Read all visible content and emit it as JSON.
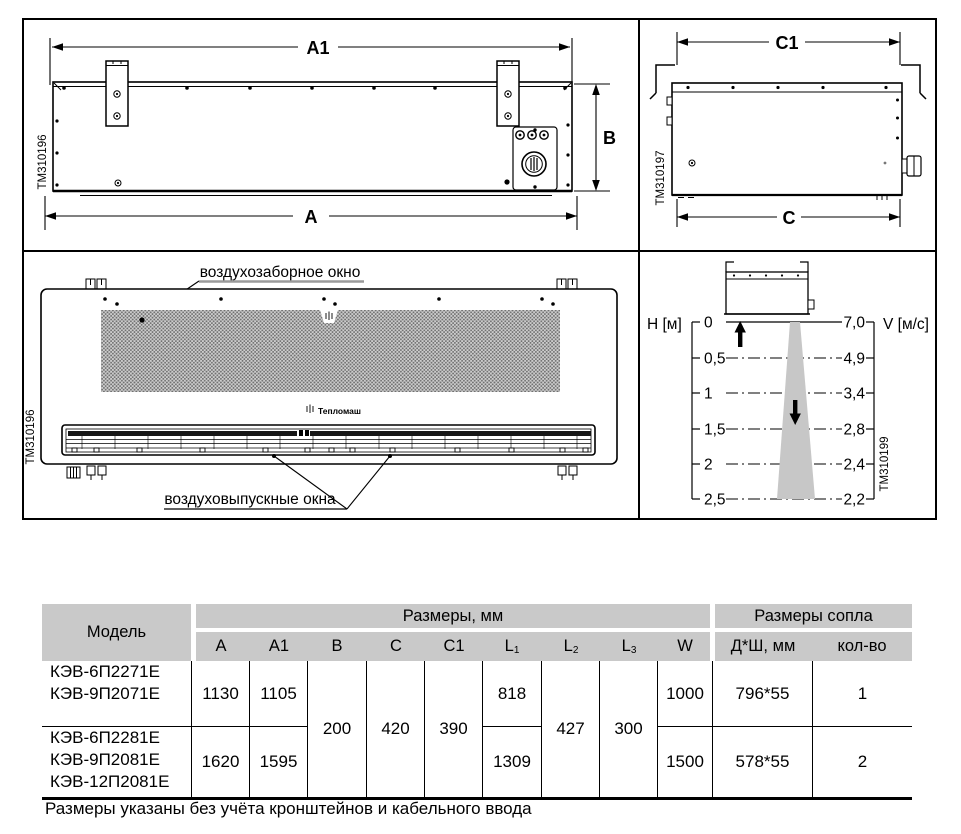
{
  "panels": {
    "front_view": {
      "code": "TM310196",
      "dims": {
        "a1": "A1",
        "a": "A",
        "b": "B"
      }
    },
    "side_view": {
      "code": "TM310197",
      "dims": {
        "c1": "C1",
        "c": "C"
      }
    },
    "bottom_view": {
      "code": "TM310196",
      "intake_label": "воздухозаборное окно",
      "outlet_label": "воздуховыпускные окна",
      "brand": "Тепломаш"
    },
    "airflow": {
      "code": "TM310199",
      "h_axis": "Н [м]",
      "v_axis": "V [м/с]",
      "h_ticks": [
        "0",
        "0,5",
        "1",
        "1,5",
        "2",
        "2,5"
      ],
      "v_ticks": [
        "7,0",
        "4,9",
        "3,4",
        "2,8",
        "2,4",
        "2,2"
      ]
    }
  },
  "chart_data": {
    "type": "line",
    "xlabel": "Н [м]",
    "ylabel": "V [м/с]",
    "x": [
      0,
      0.5,
      1,
      1.5,
      2,
      2.5
    ],
    "values": [
      7.0,
      4.9,
      3.4,
      2.8,
      2.4,
      2.2
    ],
    "legend_position": "none",
    "grid": "dashed-horizontal"
  },
  "table": {
    "header": {
      "model": "Модель",
      "dims_group": "Размеры, мм",
      "nozzle_group": "Размеры сопла",
      "cols": {
        "a": "A",
        "a1": "A1",
        "b": "B",
        "c": "C",
        "c1": "C1",
        "l": "L",
        "l1_sub": "1",
        "l2_sub": "2",
        "l3_sub": "3",
        "w": "W",
        "nozzle_size": "Д*Ш, мм",
        "nozzle_qty": "кол-во"
      }
    },
    "shared": {
      "b": "200",
      "c": "420",
      "c1": "390",
      "l2": "427",
      "l3": "300"
    },
    "rows": [
      {
        "models": [
          "КЭВ-6П2271Е",
          "КЭВ-9П2071Е"
        ],
        "a": "1130",
        "a1": "1105",
        "l1": "818",
        "w": "1000",
        "nozzle_size": "796*55",
        "nozzle_qty": "1"
      },
      {
        "models": [
          "КЭВ-6П2281Е",
          "КЭВ-9П2081Е",
          "КЭВ-12П2081Е"
        ],
        "a": "1620",
        "a1": "1595",
        "l1": "1309",
        "w": "1500",
        "nozzle_size": "578*55",
        "nozzle_qty": "2"
      }
    ]
  },
  "footnote": "Размеры указаны без учёта кронштейнов и кабельного ввода"
}
